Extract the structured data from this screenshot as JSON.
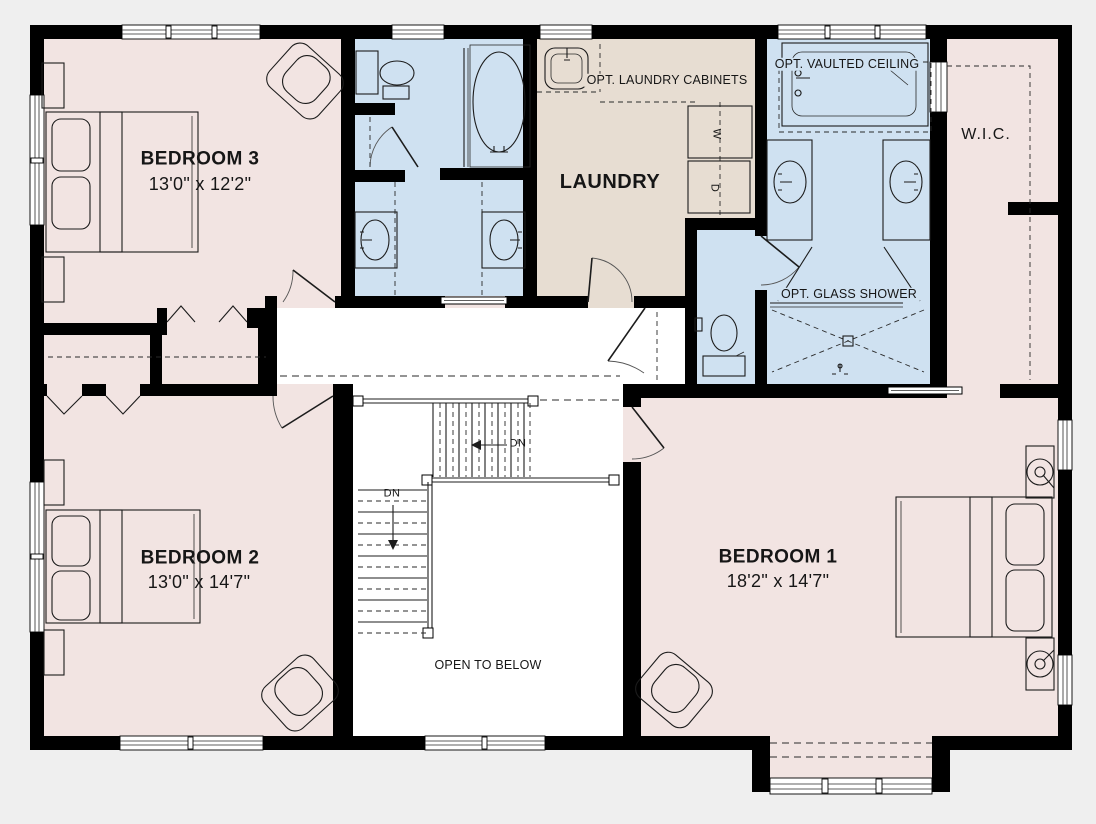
{
  "plan": {
    "colors": {
      "background": "#efefef",
      "bedroom_fill": "#f2e4e2",
      "bathroom_fill": "#cfe1f1",
      "laundry_fill": "#e7ddd2",
      "wall": "#000000",
      "hall_fill": "#ffffff"
    },
    "rooms": {
      "bedroom3": {
        "label": "BEDROOM 3",
        "dimensions": "13'0\" x 12'2\""
      },
      "bedroom2": {
        "label": "BEDROOM 2",
        "dimensions": "13'0\" x 14'7\""
      },
      "bedroom1": {
        "label": "BEDROOM 1",
        "dimensions": "18'2\" x 14'7\""
      },
      "laundry": {
        "label": "LAUNDRY"
      },
      "walk_in_closet": {
        "label": "W.I.C."
      }
    },
    "annotations": {
      "opt_laundry_cabinets": "OPT. LAUNDRY CABINETS",
      "opt_vaulted_ceiling": "OPT. VAULTED CEILING",
      "opt_glass_shower": "OPT. GLASS SHOWER",
      "open_to_below": "OPEN TO BELOW",
      "down_upper": "DN",
      "down_lower": "DN",
      "washer": "W",
      "dryer": "D"
    }
  }
}
